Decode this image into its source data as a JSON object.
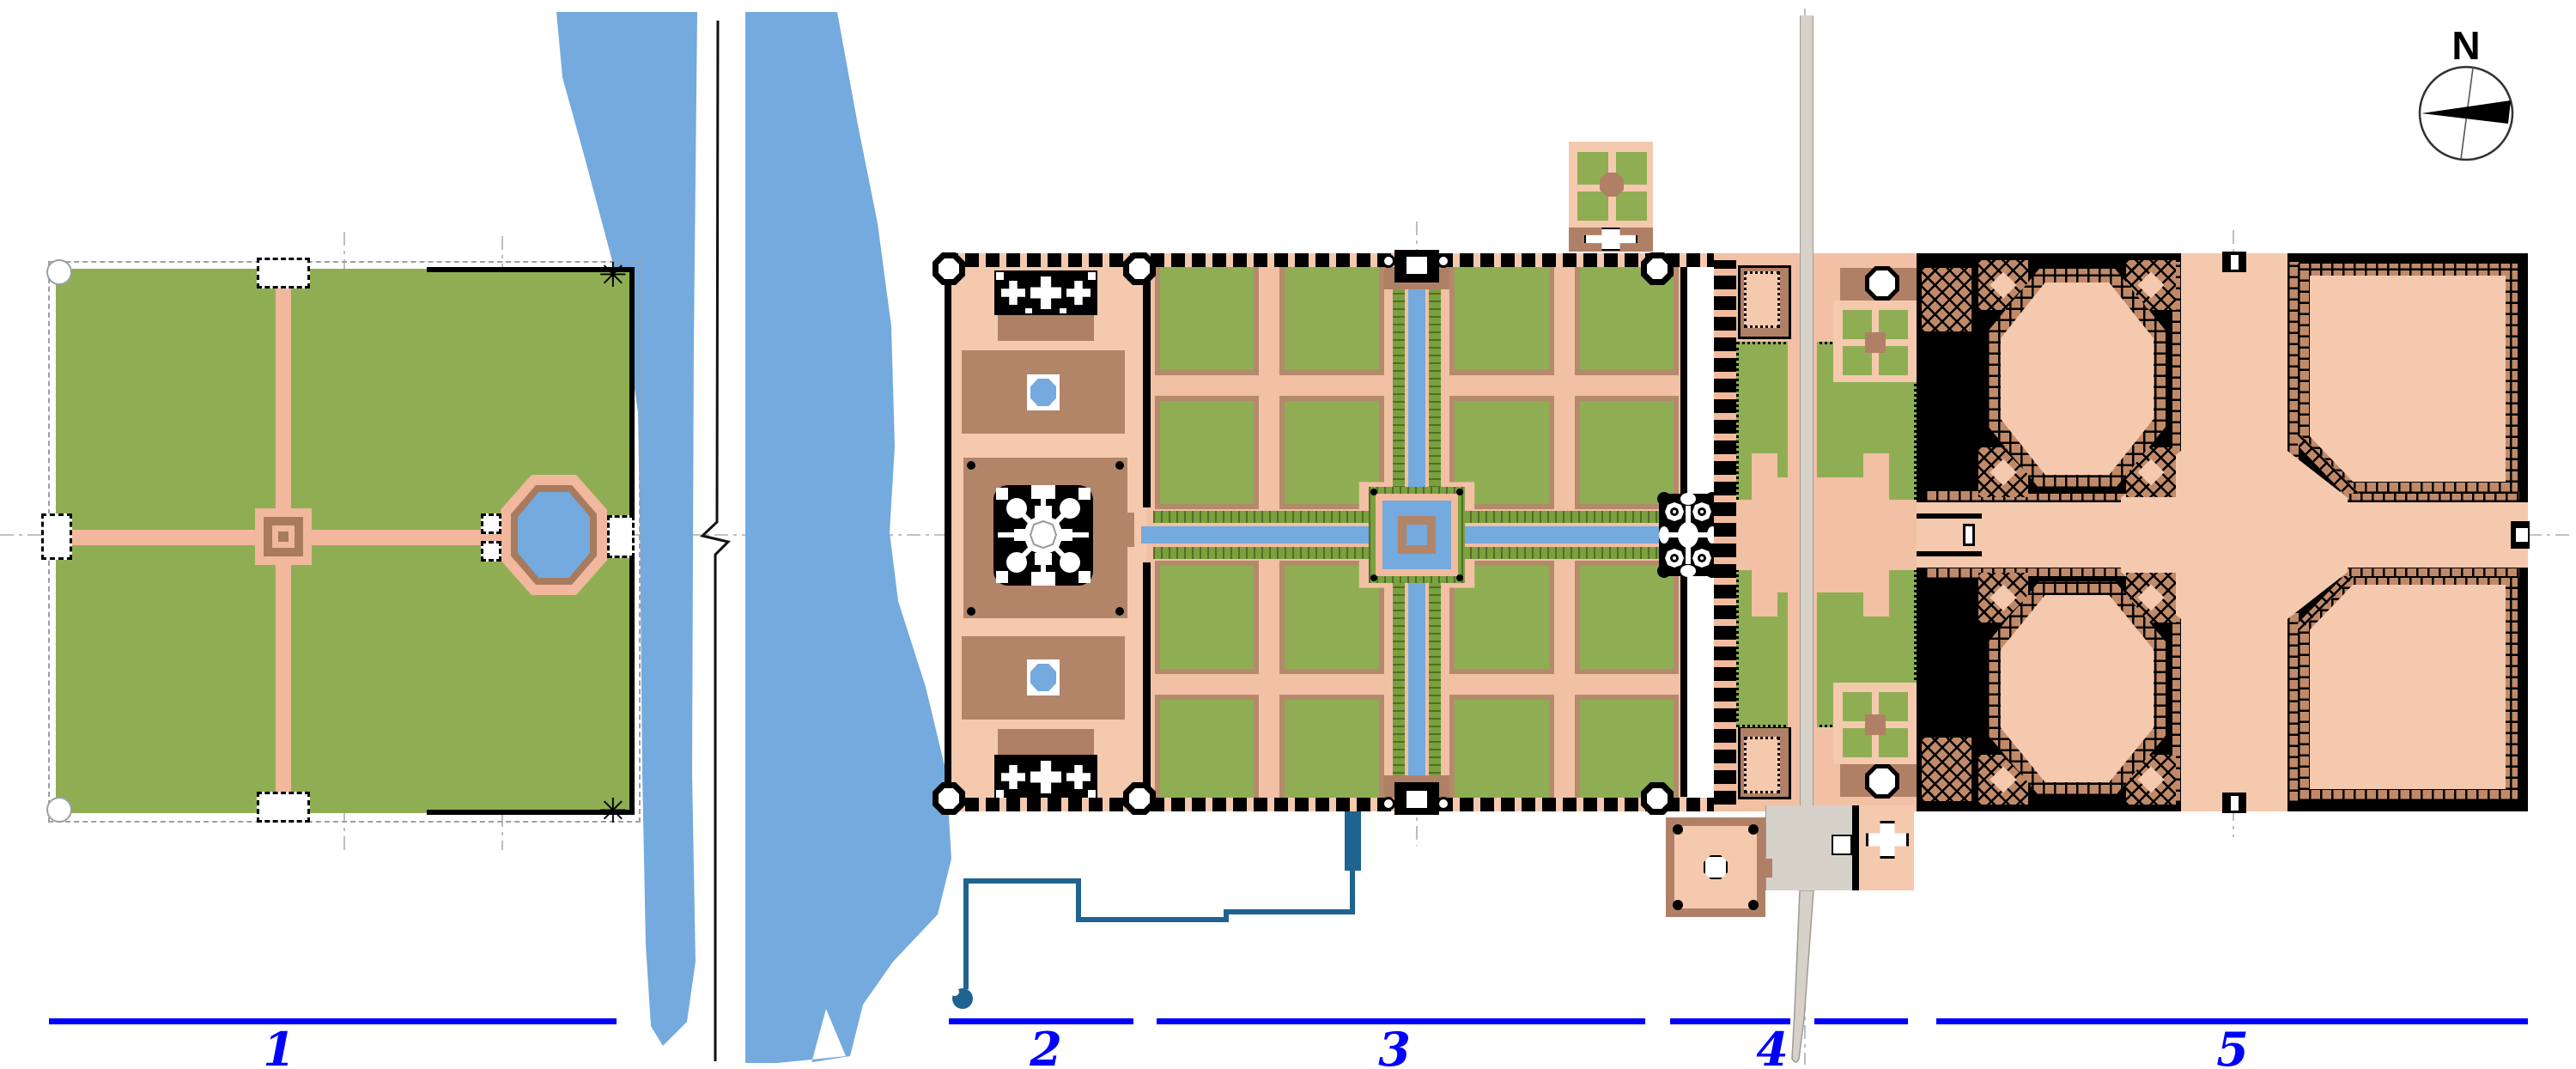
{
  "figure": {
    "type": "architectural-site-plan",
    "compass": {
      "label": "N"
    },
    "scale_bar": {
      "color": "#0000ff",
      "sections": [
        {
          "label": "1"
        },
        {
          "label": "2"
        },
        {
          "label": "3"
        },
        {
          "label": "4"
        },
        {
          "label": "5"
        }
      ]
    },
    "icons": {
      "corner_star": "✳"
    },
    "palette": {
      "background": "#ffffff",
      "river_water": "#74aadd",
      "pool_water": "#74aadd",
      "aqueduct_line": "#1f6390",
      "lawn_green": "#8fae53",
      "planting_green": "#7aa03f",
      "path_salmon": "#f2bb9e",
      "terrace_salmon": "#f5c9ae",
      "platform_brown": "#b08066",
      "parterre_edge": "#b48a6d",
      "hatch_brown": "#c08a69",
      "wall_black": "#000000",
      "road_grey": "#d6d1c9",
      "axis_grey": "#a9aeb4",
      "label_blue": "#0000ff"
    }
  }
}
